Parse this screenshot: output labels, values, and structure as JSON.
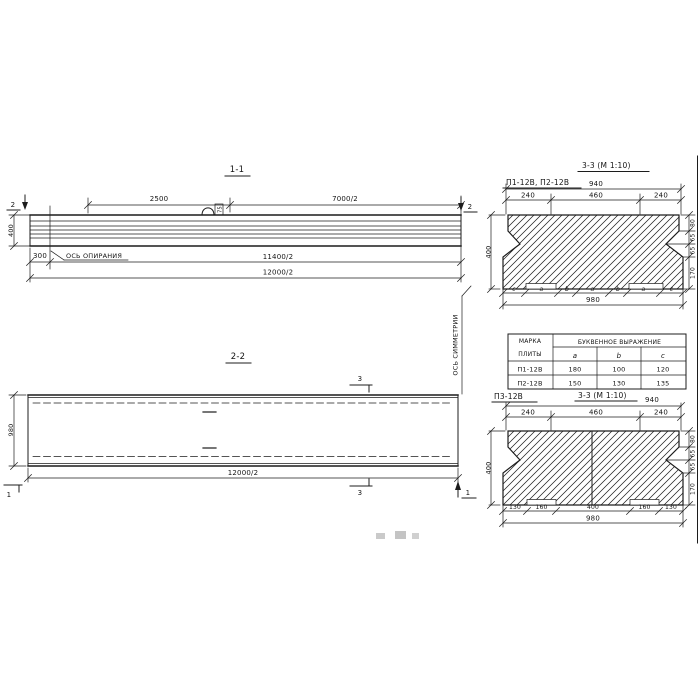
{
  "colors": {
    "ink": "#1c1c1c",
    "paper": "#ffffff"
  },
  "s11": {
    "title": "1-1",
    "m_left": "2",
    "m_right": "2",
    "d_2500": "2500",
    "d_7000": "7000/2",
    "d_400": "400",
    "d_300": "300",
    "d_11400": "11400/2",
    "d_12000": "12000/2",
    "axis": "ОСЬ ОПИРАНИЯ",
    "loop": "75"
  },
  "s22": {
    "title": "2-2",
    "m3_top": "3",
    "m3_bottom": "3",
    "m1_left": "1",
    "m1_right": "1",
    "d_980": "980",
    "d_12000": "12000/2",
    "sym": "ОСЬ СИММЕТРИИ"
  },
  "c1": {
    "label": "П1-12В, П2-12В",
    "title": "3-3 (М 1:10)",
    "d940": "940",
    "d240a": "240",
    "d460": "460",
    "d240b": "240",
    "d400": "400",
    "right": [
      "80",
      "65",
      "65",
      "170"
    ],
    "letters": [
      "c",
      "a",
      "b",
      "a",
      "b",
      "a",
      "c"
    ],
    "d980": "980"
  },
  "tbl": {
    "h1a": "МАРКА",
    "h1b": "ПЛИТЫ",
    "h2": "БУКВЕННОЕ ВЫРАЖЕНИЕ",
    "cols": [
      "a",
      "b",
      "c"
    ],
    "rows": [
      [
        "П1-12В",
        "180",
        "100",
        "120"
      ],
      [
        "П2-12В",
        "150",
        "130",
        "135"
      ]
    ]
  },
  "c2": {
    "label": "П3-12В",
    "title": "3-3 (М 1:10)",
    "d940": "940",
    "d240a": "240",
    "d460": "460",
    "d240b": "240",
    "d400": "400",
    "right": [
      "80",
      "65",
      "65",
      "170"
    ],
    "bottom": [
      "130",
      "160",
      "400",
      "160",
      "130"
    ],
    "d980": "980"
  }
}
